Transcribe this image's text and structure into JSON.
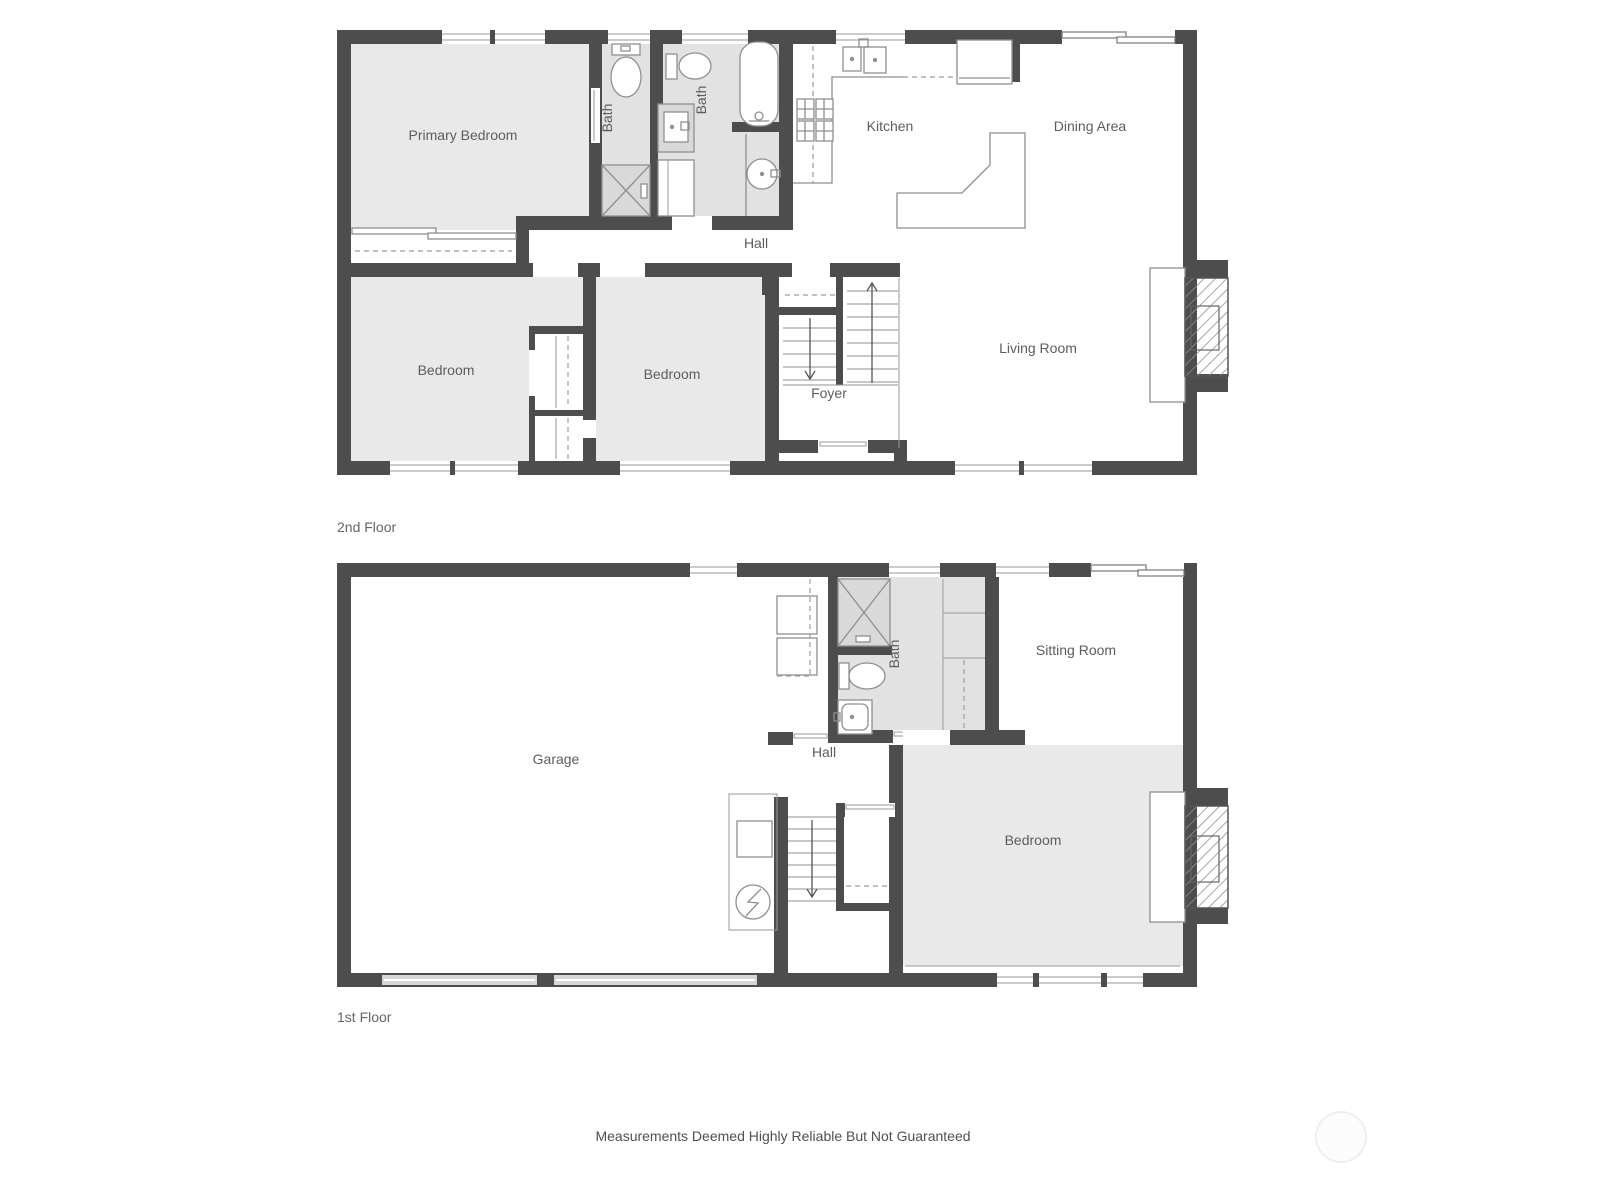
{
  "colors": {
    "wall": "#4d4d4d",
    "shaded_room_fill": "#e9e9e9",
    "bath_fill": "#e2e2e2",
    "fixture_line": "#8f8f8f",
    "label_text": "#5d5d5d"
  },
  "floor2": {
    "caption": "2nd Floor",
    "rooms": {
      "primary_bedroom": "Primary Bedroom",
      "bath_primary": "Bath",
      "bath_hall": "Bath",
      "kitchen": "Kitchen",
      "dining_area": "Dining Area",
      "hall": "Hall",
      "bedroom_left": "Bedroom",
      "bedroom_right": "Bedroom",
      "foyer": "Foyer",
      "living_room": "Living Room"
    }
  },
  "floor1": {
    "caption": "1st Floor",
    "rooms": {
      "garage": "Garage",
      "bath": "Bath",
      "sitting_room": "Sitting Room",
      "hall": "Hall",
      "bedroom": "Bedroom"
    }
  },
  "footer": {
    "disclaimer": "Measurements Deemed Highly Reliable But Not Guaranteed"
  }
}
